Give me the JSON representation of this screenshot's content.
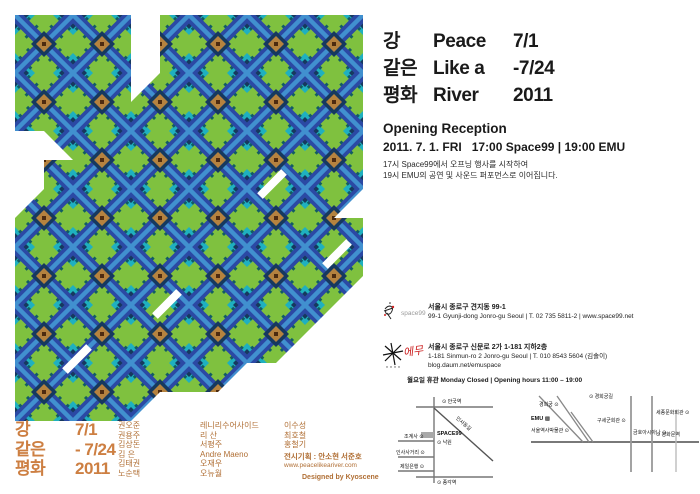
{
  "title": {
    "rows": [
      {
        "kr": "강",
        "en": "Peace",
        "date": "7/1"
      },
      {
        "kr": "같은",
        "en": "Like a",
        "date": "-7/24"
      },
      {
        "kr": "평화",
        "en": "River",
        "date": "2011"
      }
    ]
  },
  "reception": {
    "heading": "Opening Reception",
    "line": "2011. 7. 1. FRI   17:00 Space99 | 19:00 EMU",
    "desc1": "17시 Space99에서 오프닝 행사를 시작하여",
    "desc2": "19시 EMU의 공연 및 사운드 퍼포먼스로 이어집니다."
  },
  "venues": [
    {
      "logo": "space99",
      "logo_text": "space99",
      "addr_kr": "서울시 종로구 견지동 99-1",
      "addr_en": "99-1 Gyunji-dong Jonro-gu Seoul | T. 02 735 5811-2 | www.space99.net"
    },
    {
      "logo": "emu",
      "logo_text": "에무",
      "addr_kr": "서울시 종로구 신문로 2가 1-181 지하2층",
      "addr_en": "1-181 Sinmun-ro 2 Jonro-gu Seoul | T. 010 8543 5604 (김솔이)",
      "addr_web": "blog.daum.net/emuspace"
    }
  ],
  "hours": "월요일 휴관 Monday Closed | Opening hours 11:00 – 19:00",
  "maps": {
    "space99_map": {
      "station_top": "⊙ 안국역",
      "street_diagonal": "인사동길",
      "venue": "SPACE99",
      "below_venue": "⊙ 낙원",
      "left1": "조계사 ⊙",
      "left2": "인사사거리 ⊙",
      "left3": "제일은행 ⊙",
      "station_bottom": "⊙ 종각역"
    },
    "emu_map": {
      "street_top": "⊙ 경희궁길",
      "venue": "EMU ▩",
      "left1": "경희궁 ⊙",
      "left2": "서울역사박물관 ⊙",
      "mid1": "구세군회관 ⊙",
      "mid2": "금호아시아나 ⊙",
      "right1": "세종문화회관 ⊙",
      "right2": "⊙ 광화문역"
    }
  },
  "credits": {
    "title_kr": [
      "강",
      "같은",
      "평화"
    ],
    "dates": [
      "7/1",
      "- 7/24",
      "2011"
    ],
    "artists_col1": [
      "권오준",
      "권용주",
      "김상돈",
      "김  은",
      "김태권",
      "노순택"
    ],
    "artists_col2": [
      "레니리수어사이드",
      "리  산",
      "서평주",
      "Andre Maeno",
      "오재우",
      "오뉴월"
    ],
    "artists_col3": [
      "이수성",
      "최호철",
      "홍철기"
    ],
    "organizer": "전시기획 : 안소현 서준호",
    "website": "www.peacelikeariver.com",
    "designer": "Designed by Kyoscene"
  },
  "colors": {
    "green": "#7fc13f",
    "royal_blue": "#2b49a4",
    "light_blue": "#4190cf",
    "navy": "#16395f",
    "teal": "#1fb0bf",
    "dark_teal": "#125c63",
    "copper": "#b5823f",
    "credit_orange": "#cd7f42",
    "credit_brown": "#b06f35",
    "logo_red": "#cc2222"
  },
  "pattern": {
    "cell": 29,
    "grid": [
      "QQQQ.QQQQQQQ",
      "QQQQ.QQQQQQQ",
      "QQQQdQQQQQQQ",
      "QQQQQQQQQQQQ",
      ".bQQQQQQQQQQ",
      ".QQQQQQQQQQQ",
      "dQQQQQQQQQQc",
      "QQQQQQQQQQQQ",
      "QQQQQQQQQQQQ",
      "QQQQQQQQQQQc",
      "QQQQQQQQQQc.",
      "QQQQQQQQQc..",
      "QQQQQQQc....",
      "QQQQc......."
    ],
    "slashes": [
      {
        "x": 135,
        "y": 285
      },
      {
        "x": 240,
        "y": 165
      },
      {
        "x": 45,
        "y": 340
      },
      {
        "x": 305,
        "y": 235
      }
    ]
  }
}
